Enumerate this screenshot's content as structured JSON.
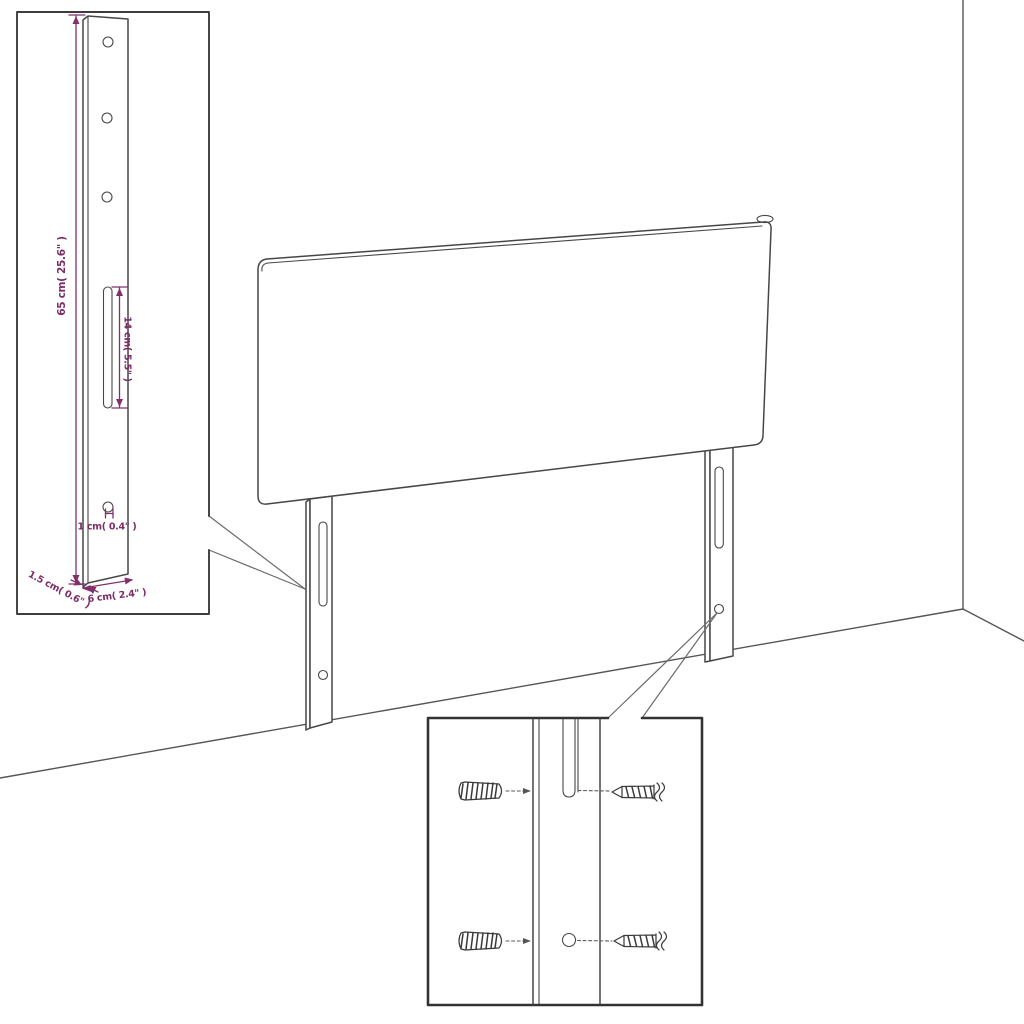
{
  "diagram": {
    "background": "#ffffff",
    "line_color": "#474747",
    "dimension_color": "#7d2b66"
  },
  "labels": {
    "leg_height": "65 cm( 25.6\" )",
    "slot_length": "14 cm( 5.5\" )",
    "hole_diameter": "1 cm( 0.4\" )",
    "leg_thickness": "1.5 cm( 0.6\" )",
    "leg_width": "6 cm( 2.4\" )"
  }
}
